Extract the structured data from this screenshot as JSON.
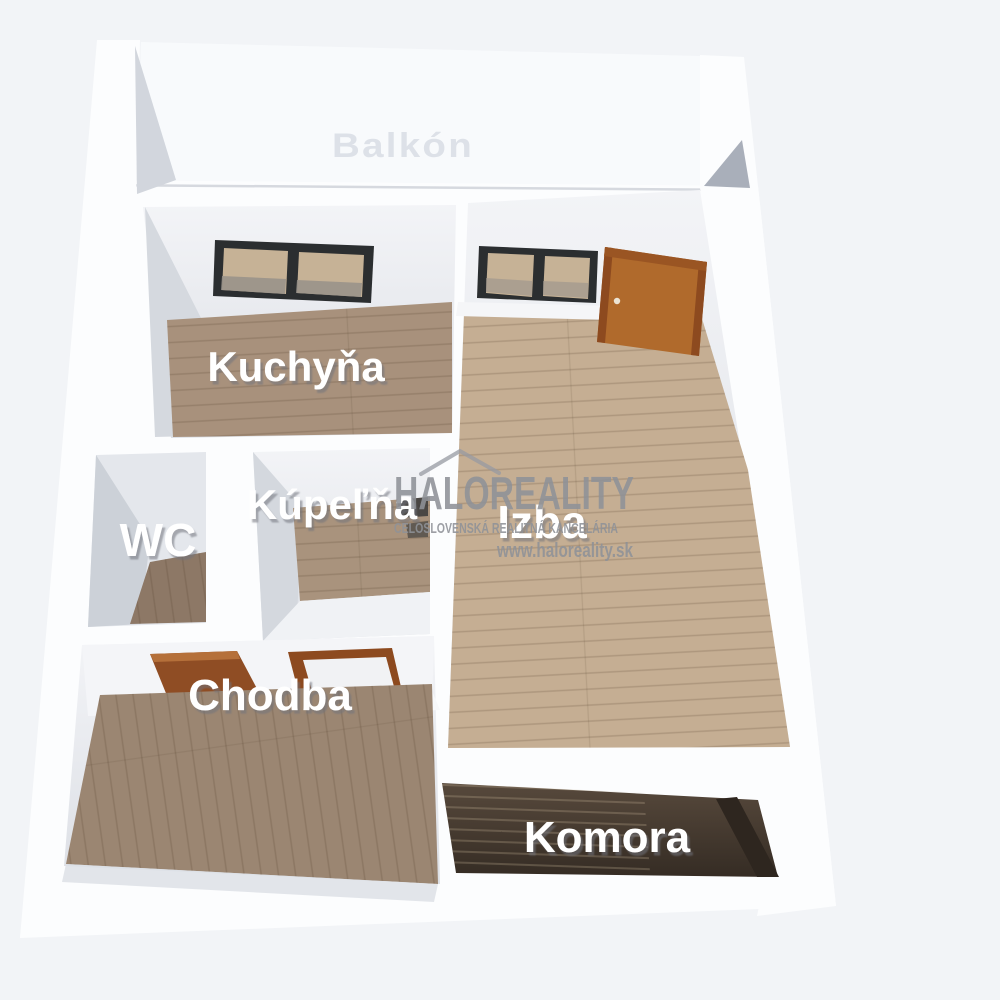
{
  "scene": {
    "description": "3D rendered floor plan of a one-room apartment, top-down oblique view",
    "rooms": {
      "balkon": {
        "label": "Balkón"
      },
      "kuchyna": {
        "label": "Kuchyňa"
      },
      "izba": {
        "label": "Izba"
      },
      "wc": {
        "label": "WC"
      },
      "kupelna": {
        "label": "Kúpeľňa"
      },
      "chodba": {
        "label": "Chodba"
      },
      "komora": {
        "label": "Komora"
      }
    },
    "watermark": {
      "brand": "HALOREALITY",
      "subtitle": "CELOSLOVENSKÁ REALITNÁ KANCELÁRIA",
      "url": "www.haloreality.sk"
    },
    "colors": {
      "background": "#f2f4f7",
      "wall": "#fcfdfe",
      "wall_face_shade": "#d2d6dd",
      "floor_kitchen": "#a8917c",
      "floor_room": "#c5ae93",
      "floor_hall": "#9b8672",
      "floor_bath": "#a9937d",
      "floor_wc": "#8d7866",
      "pantry_dark": "#42382e",
      "door_wood": "#b06a2c",
      "door_frame": "#8d4a1f",
      "window_frame": "#2b2e30",
      "window_view": "#c6b296",
      "watermark_gray": "#8f9298",
      "label_white": "#ffffff"
    }
  }
}
